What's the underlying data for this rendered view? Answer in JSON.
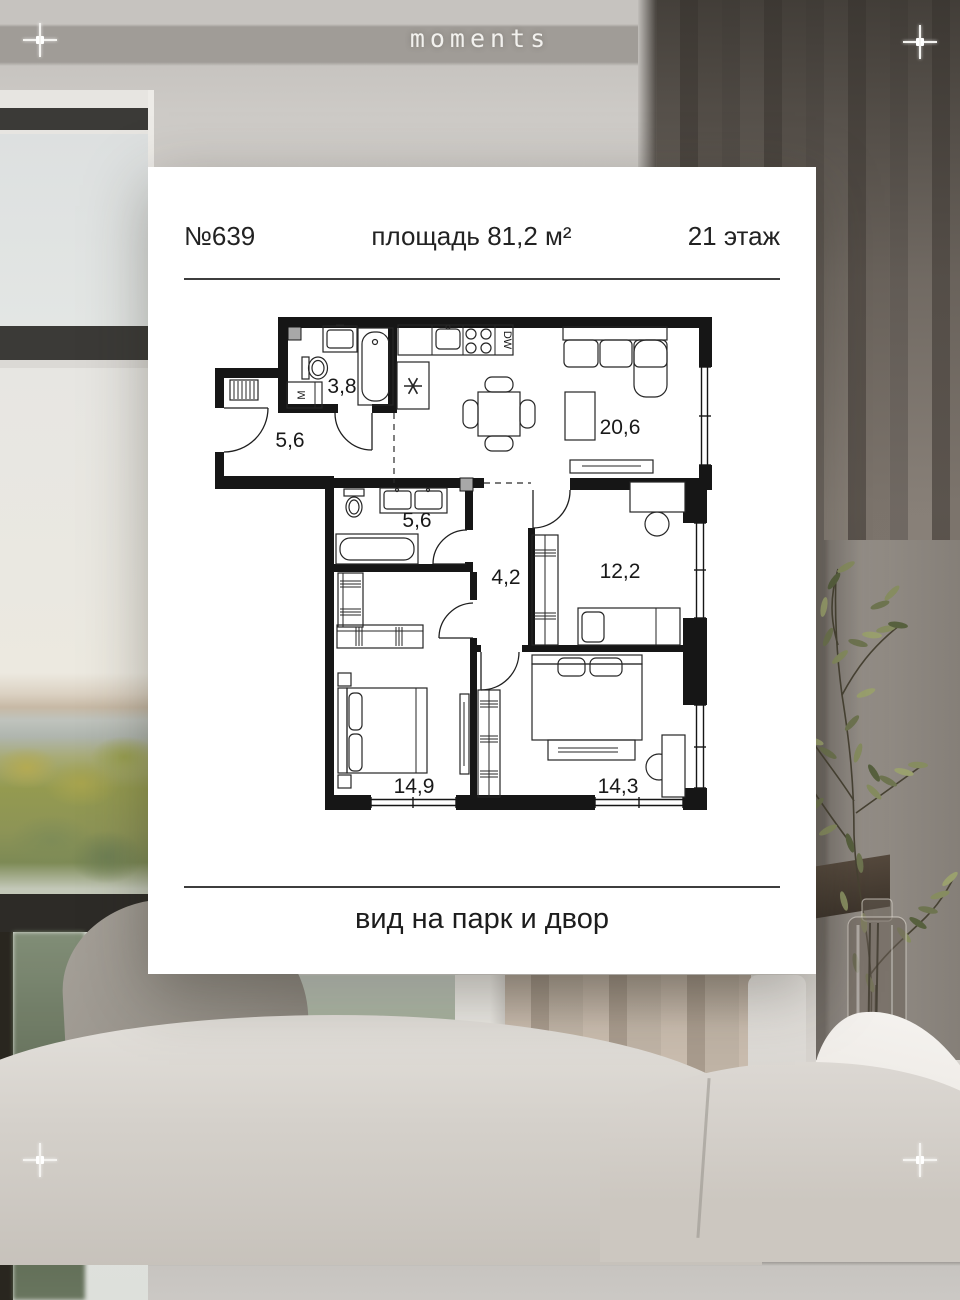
{
  "brand": {
    "logo_text": "moments"
  },
  "card": {
    "header": {
      "unit_number": "№639",
      "area_label": "площадь 81,2 м²",
      "floor_label": "21 этаж"
    },
    "floor_plan": {
      "room_areas": {
        "bathroom_small": "3,8",
        "entry_hall": "5,6",
        "kitchen_living": "20,6",
        "bathroom_main": "5,6",
        "corridor": "4,2",
        "bedroom_kids": "12,2",
        "bedroom_master": "14,9",
        "bedroom_second": "14,3"
      },
      "appliance_labels": {
        "washing_machine": "M",
        "dishwasher": "DW"
      }
    },
    "footer": {
      "view_label": "вид на парк и двор"
    }
  },
  "colors": {
    "plan_walls": "#161616",
    "card_background": "#ffffff",
    "logo_text": "#f2f1ee"
  }
}
